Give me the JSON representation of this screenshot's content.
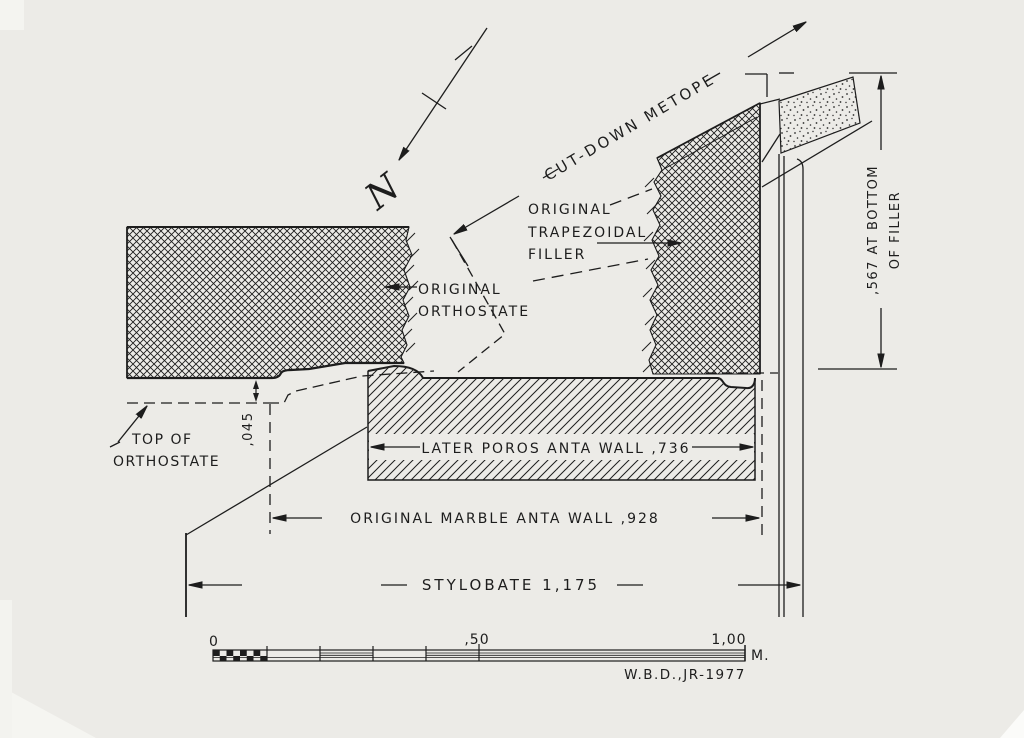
{
  "north_label": "N",
  "labels": {
    "cut_down_metope": "CUT-DOWN METOPE",
    "filler_1": "ORIGINAL",
    "filler_2": "TRAPEZOIDAL",
    "filler_3": "FILLER",
    "orthostate_1": "ORIGINAL",
    "orthostate_2": "ORTHOSTATE",
    "top_orthostate_1": "TOP OF",
    "top_orthostate_2": "ORTHOSTATE"
  },
  "dims": {
    "filler_height_1": ",567 AT BOTTOM",
    "filler_height_2": "OF FILLER",
    "orthostate_offset": ",045",
    "poros_wall": "LATER POROS ANTA WALL ,736",
    "marble_wall": "ORIGINAL MARBLE ANTA WALL ,928",
    "stylobate": "STYLOBATE 1,175"
  },
  "scale": {
    "zero": "0",
    "half": ",50",
    "one": "1,00",
    "unit": "M."
  },
  "credit": "W.B.D.,JR-1977",
  "colors": {
    "paper": "#ecebe7",
    "ink": "#1d1d1d"
  }
}
